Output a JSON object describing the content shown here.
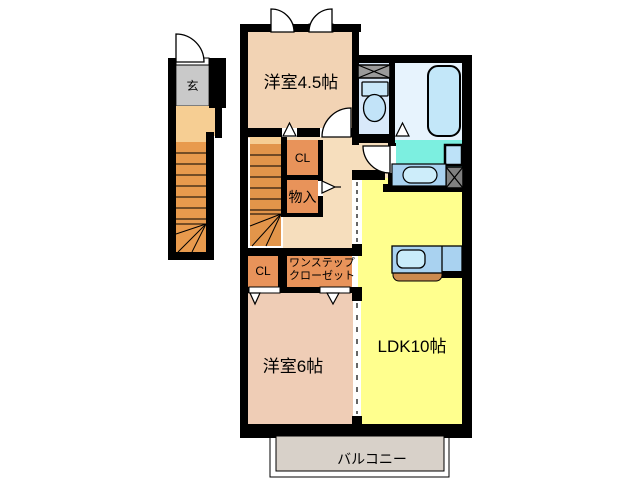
{
  "plan": {
    "entrance": "玄",
    "room_4_5": "洋室4.5帖",
    "closet_upper": "CL",
    "storage": "物入",
    "one_step_closet_line1": "ワンステップ",
    "one_step_closet_line2": "クローゼット",
    "closet_lower": "CL",
    "room_6": "洋室6帖",
    "ldk": "LDK10帖",
    "balcony": "バルコニー"
  },
  "palette": {
    "wall": "#000000",
    "room_tan": "#F2D3B4",
    "hall_peach": "#F6DEBD",
    "room_pink": "#EFCDB6",
    "ldk_yellow": "#FFFF8E",
    "closet_orange": "#E8935A",
    "stairs_orange": "#E89A4D",
    "stairs_light": "#F6CE93",
    "entrance_gray": "#C9C9C9",
    "toilet_blue": "#D9E9FA",
    "bath_blue": "#E7F3FD",
    "washroom_aqua": "#7CEFE0",
    "fixture_blue": "#C3E7F9",
    "counter_blue": "#A9D2F0",
    "kitchen_front_brown": "#CC8A4E",
    "balcony_gray": "#D8D1C9"
  }
}
